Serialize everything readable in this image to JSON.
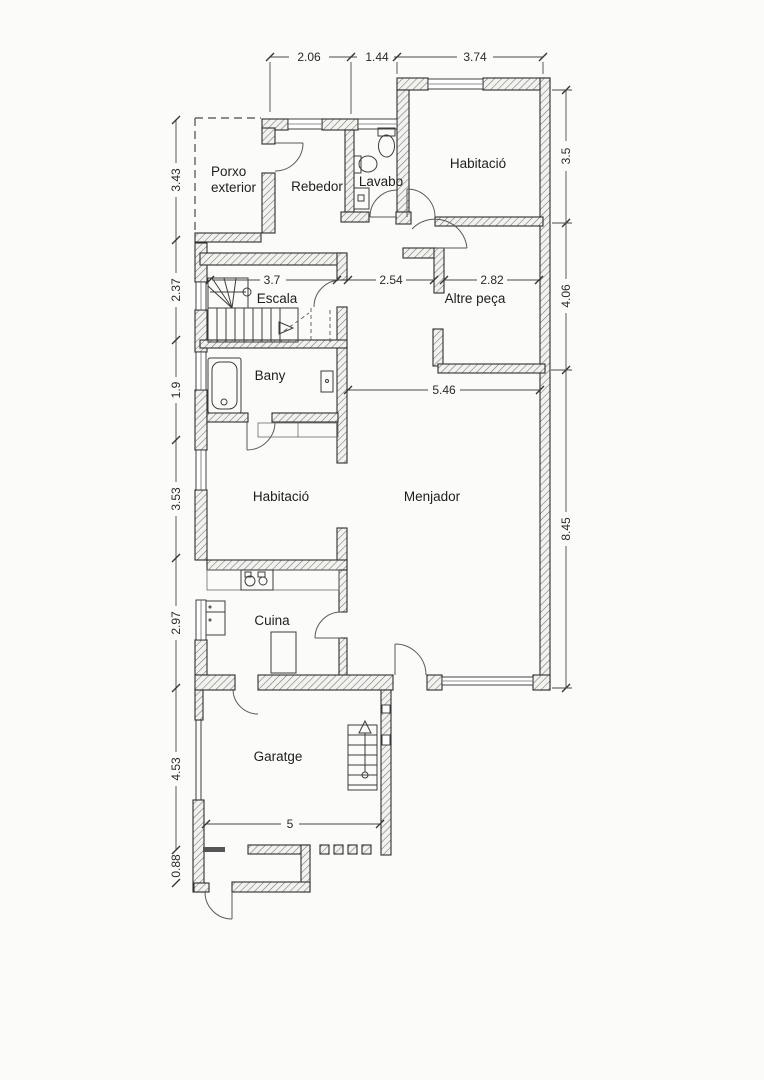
{
  "page": {
    "type": "scanned floor plan",
    "background": "#fbfbf9"
  },
  "rooms": {
    "porxo_line1": "Porxo",
    "porxo_line2": "exterior",
    "rebedor": "Rebedor",
    "lavabo": "Lavabo",
    "habitacio_top": "Habitació",
    "escala": "Escala",
    "altre_peca": "Altre peça",
    "bany": "Bany",
    "habitacio_mid": "Habitació",
    "menjador": "Menjador",
    "cuina": "Cuina",
    "garatge": "Garatge"
  },
  "dimensions": {
    "top": [
      "2.06",
      "1.44",
      "3.74"
    ],
    "right": [
      "3.5",
      "4.06",
      "8.45"
    ],
    "left": [
      "3.43",
      "2.37",
      "1.9",
      "3.53",
      "2.97",
      "4.53",
      "0.88"
    ],
    "interior": {
      "escala": "3.7",
      "hall": "2.54",
      "altre_peca": "2.82",
      "menjador": "5.46",
      "garatge": "5"
    }
  },
  "colors": {
    "wall_line": "#2f2f2f",
    "hatch": "#707070",
    "dim_line": "#4a4a4a",
    "text": "#222222",
    "paper": "#fbfbf9"
  }
}
